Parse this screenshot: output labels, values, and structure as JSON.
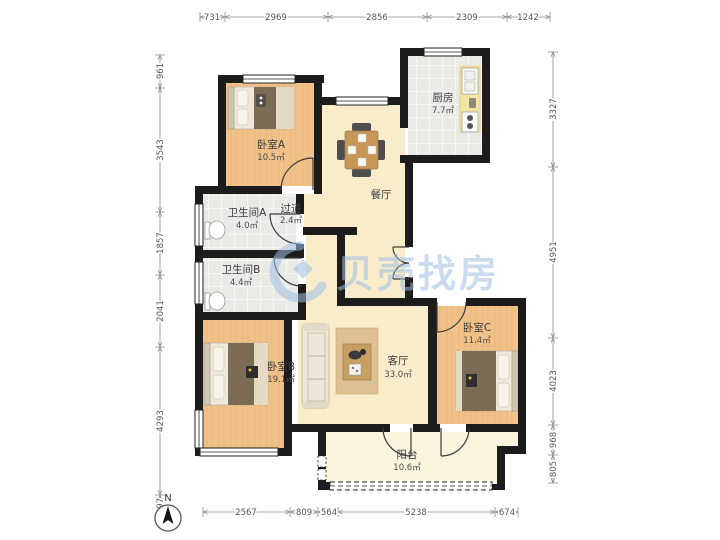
{
  "plan": {
    "watermark_text": "贝壳找房",
    "compass_label": "N",
    "rooms": {
      "bedroomA": {
        "name": "卧室A",
        "area": "10.5㎡"
      },
      "kitchen": {
        "name": "厨房",
        "area": "7.7㎡"
      },
      "dining": {
        "name": "餐厅",
        "area": ""
      },
      "hallway": {
        "name": "过道",
        "area": "2.4㎡"
      },
      "bathA": {
        "name": "卫生间A",
        "area": "4.0㎡"
      },
      "bathB": {
        "name": "卫生间B",
        "area": "4.4㎡"
      },
      "bedroomB": {
        "name": "卧室B",
        "area": "19.1㎡"
      },
      "living": {
        "name": "客厅",
        "area": "33.0㎡"
      },
      "bedroomC": {
        "name": "卧室C",
        "area": "11.4㎡"
      },
      "balcony": {
        "name": "阳台",
        "area": "10.6㎡"
      }
    },
    "dimensions_mm": {
      "top": [
        "731",
        "2969",
        "2856",
        "2309",
        "1242"
      ],
      "left": [
        "961",
        "3543",
        "1857",
        "2041",
        "4293",
        "597"
      ],
      "right": [
        "3327",
        "4951",
        "4023",
        "968",
        "805"
      ],
      "bottom": [
        "2567",
        "809",
        "564",
        "5238",
        "674"
      ]
    },
    "colors": {
      "wall": "#1c1c1c",
      "bedroom_floor": "#F0C289",
      "living_floor": "#F8ECCB",
      "tile_floor": "#E9E9E6",
      "balcony_floor": "#F8F4DE",
      "watermark_blue": "#9FBFE3"
    }
  }
}
